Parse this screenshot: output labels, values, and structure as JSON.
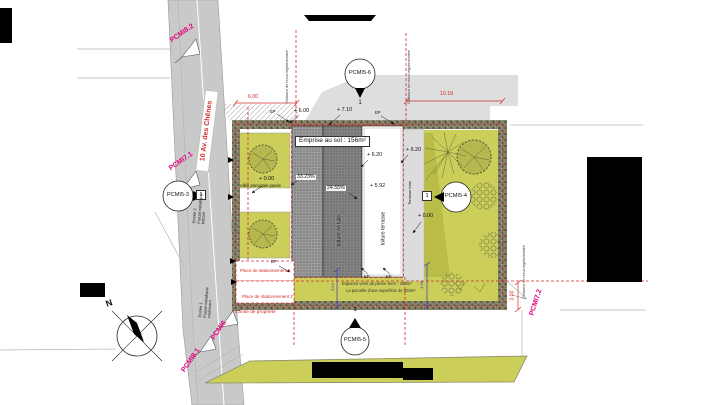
{
  "plan_title": "Emprise au sol : 156m²",
  "street": {
    "name": "10 Av. des Chênes"
  },
  "pcmi_markers": {
    "pcmi82": "PCMI8.2",
    "pcmi71": "PCMI7.1",
    "pcmi6": "PCMI6",
    "pcmi81": "PCMI8.1",
    "pcmi72": "PCMI7.2"
  },
  "section_markers": {
    "left": {
      "label": "PCMI5-3",
      "number": "1"
    },
    "top": {
      "label": "PCMI5-6",
      "number": "1"
    },
    "right": {
      "label": "PCMI5-4",
      "number": "1"
    },
    "bottom": {
      "label": "PCMI5-5",
      "number": "1"
    }
  },
  "dimensions": {
    "front_width": "6.00",
    "rear_width": "10.18",
    "side_setback": "3.00",
    "green_depth_left": "3.94",
    "green_depth_right": "4.36"
  },
  "elevations": {
    "street_level": "+ 0.00",
    "terrace_level": "+ 0.00",
    "eave": "+ 6.00",
    "ridge": "+ 7.10",
    "flat_roof": "+ 6.20",
    "roof_deck": "+ 6.20",
    "flat_roof_low": "+ 5.92"
  },
  "roof": {
    "slope_left": "33.23%",
    "slope_right": "24.55%",
    "tile_label": "toiture en tuile",
    "flat_label": "toiture terrasse",
    "deck_label": "Terrasse bois",
    "downspout": "EP"
  },
  "site": {
    "setback_note": "Distance de recul réglementaire",
    "path": "Allée principale pavée",
    "parking1": "Place de stationnement 1",
    "parking2": "Place de stationnement 2",
    "boundary": "Limite de propriété",
    "green1": "Espaces verts de pleine terre : 252m²",
    "green2": "La parcelle d'une superficie de 502m²"
  },
  "entrances": {
    "e1_line1": "Entrée 1",
    "e1_line2": "Portail métallique",
    "e1_line3": "coulissant",
    "e2_line1": "Entrée 2",
    "e2_line2": "Portail métallique",
    "e2_line3": "battant"
  },
  "compass": {
    "north": "N"
  },
  "colors": {
    "lawn": "#cbce58",
    "hedge": "#7e7e66",
    "road": "#c9c9c9",
    "dim_red": "#d42b2b",
    "pcmi_pink": "#e5007d",
    "dim_blue": "#3b3bb5"
  }
}
